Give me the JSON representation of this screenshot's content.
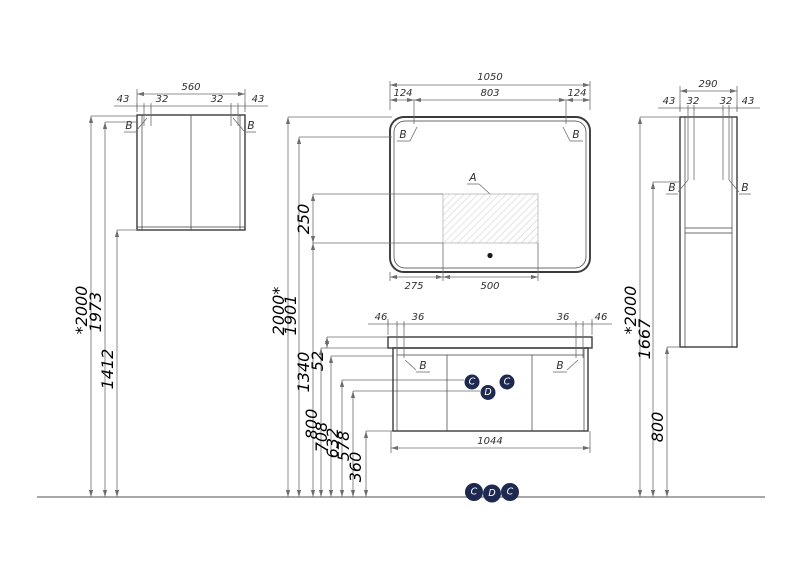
{
  "colors": {
    "line": "#3b3b3b",
    "dim": "#6e6e6e",
    "floor": "#8c8c8c",
    "text": "#2e2e2e",
    "knob_fill": "#1e2951",
    "knob_text": "#ffffff",
    "hatch": "#d8d8d8"
  },
  "wall_cabinet": {
    "width": "560",
    "offsets": [
      "43",
      "32",
      "32",
      "43"
    ],
    "callouts": [
      "B",
      "B"
    ]
  },
  "mirror": {
    "width": "1050",
    "top_offsets": [
      "124",
      "803",
      "124"
    ],
    "callouts": [
      "B",
      "B"
    ],
    "zone_label": "A",
    "bottom_offsets": [
      "275",
      "500"
    ]
  },
  "vanity": {
    "top_offsets": [
      "46",
      "36",
      "36",
      "46"
    ],
    "width": "1044",
    "callouts": [
      "B",
      "B"
    ],
    "knobs": [
      "C",
      "D",
      "C"
    ]
  },
  "tall_cabinet": {
    "width": "290",
    "offsets": [
      "43",
      "32",
      "32",
      "43"
    ],
    "callouts": [
      "B",
      "B"
    ]
  },
  "heights": {
    "left": [
      "*2000",
      "1973",
      "1412"
    ],
    "middle": [
      "2000*",
      "1901",
      "250",
      "1340",
      "52",
      "800",
      "708",
      "632",
      "578",
      "360"
    ],
    "right": [
      "*2000",
      "1667",
      "800"
    ]
  },
  "floor_fittings": [
    "C",
    "D",
    "C"
  ]
}
